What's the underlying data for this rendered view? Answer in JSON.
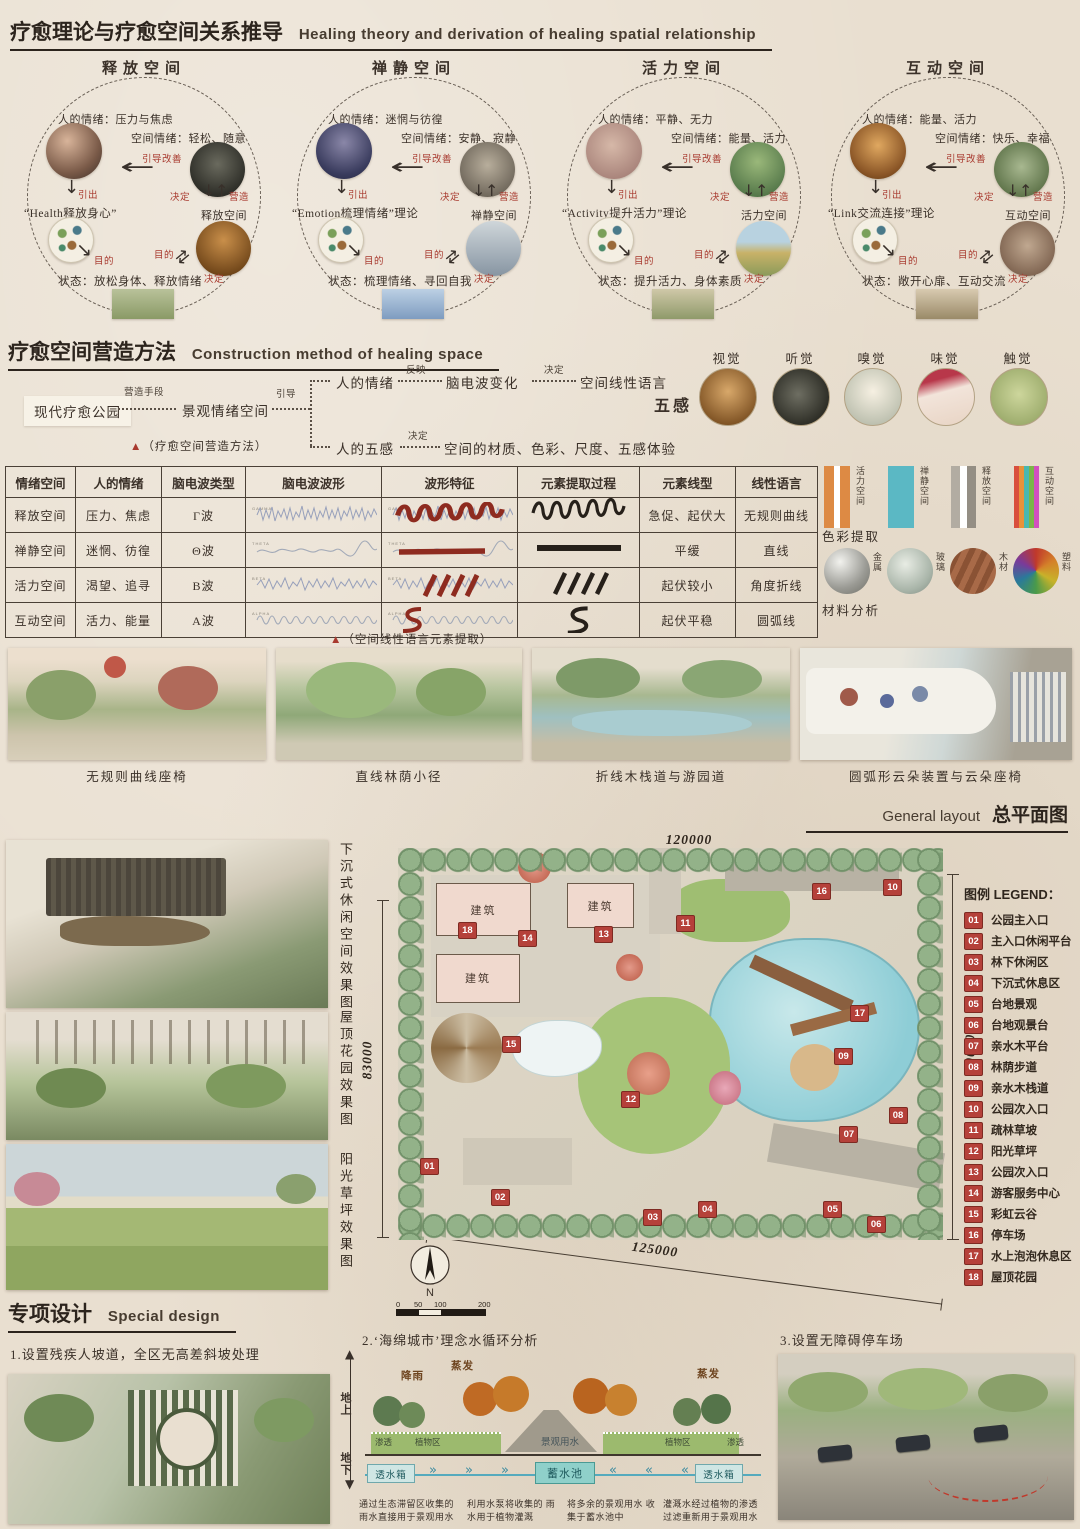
{
  "header": {
    "title_zh": "疗愈理论与疗愈空间关系推导",
    "title_en": "Healing theory and derivation of healing spatial relationship"
  },
  "circle_labels": {
    "improve": "引导改善",
    "lead": "引出",
    "decide": "决定",
    "create": "营造",
    "purpose": "目的"
  },
  "circles": [
    {
      "title": "释放空间",
      "human_emotion": "人的情绪：压力与焦虑",
      "space_emotion": "空间情绪：轻松、随意",
      "theory": "“Health释放身心”",
      "space_name": "释放空间",
      "state": "状态：放松身体、释放情绪"
    },
    {
      "title": "禅静空间",
      "human_emotion": "人的情绪：迷惘与彷徨",
      "space_emotion": "空间情绪：安静、寂静",
      "theory": "“Emotion梳理情绪”理论",
      "space_name": "禅静空间",
      "state": "状态：梳理情绪、寻回自我"
    },
    {
      "title": "活力空间",
      "human_emotion": "人的情绪：平静、无力",
      "space_emotion": "空间情绪：能量、活力",
      "theory": "“Activity提升活力”理论",
      "space_name": "活力空间",
      "state": "状态：提升活力、身体素质"
    },
    {
      "title": "互动空间",
      "human_emotion": "人的情绪：能量、活力",
      "space_emotion": "空间情绪：快乐、幸福",
      "theory": "“Link交流连接”理论",
      "space_name": "互动空间",
      "state": "状态：敞开心扉、互动交流"
    }
  ],
  "construction": {
    "title_zh": "疗愈空间营造方法",
    "title_en": "Construction method of healing space",
    "start": "现代疗愈公园",
    "m1": "营造手段",
    "mid": "景观情绪空间",
    "m2": "引导",
    "b1": [
      "人的情绪",
      "反映",
      "脑电波变化",
      "决定",
      "空间线性语言"
    ],
    "b2": [
      "人的五感",
      "决定",
      "空间的材质、色彩、尺度、五感体验"
    ],
    "caption_marker": "▲",
    "caption": "（疗愈空间营造方法）",
    "senses_label": "五感",
    "senses": [
      "视觉",
      "听觉",
      "嗅觉",
      "味觉",
      "触觉"
    ]
  },
  "eeg": {
    "headers": [
      "情绪空间",
      "人的情绪",
      "脑电波类型",
      "脑电波波形",
      "波形特征",
      "元素提取过程",
      "元素线型",
      "线性语言"
    ],
    "rows": [
      {
        "space": "释放空间",
        "emotion": "压力、焦虑",
        "wave_type": "Γ波",
        "wave_label": "GAMMA",
        "line_type": "急促、起伏大",
        "line_lang": "无规则曲线"
      },
      {
        "space": "禅静空间",
        "emotion": "迷惘、彷徨",
        "wave_type": "Θ波",
        "wave_label": "THETA",
        "line_type": "平缓",
        "line_lang": "直线"
      },
      {
        "space": "活力空间",
        "emotion": "渴望、追寻",
        "wave_type": "Β波",
        "wave_label": "BETA",
        "line_type": "起伏较小",
        "line_lang": "角度折线"
      },
      {
        "space": "互动空间",
        "emotion": "活力、能量",
        "wave_type": "Α波",
        "wave_label": "ALPHA",
        "line_type": "起伏平稳",
        "line_lang": "圆弧线"
      }
    ],
    "caption_marker": "▲",
    "caption": "（空间线性语言元素提取）"
  },
  "extraction": {
    "swatches": [
      {
        "label": "活力空间",
        "colors": [
          "#dd8a44",
          "#ffffff",
          "#dd8a44"
        ]
      },
      {
        "label": "禅静空间",
        "colors": [
          "#5bb8c4"
        ]
      },
      {
        "label": "释放空间",
        "colors": [
          "#b2aca2",
          "#ffffff",
          "#948e84"
        ]
      },
      {
        "label": "互动空间",
        "colors": [
          "#d94f3d",
          "#e8923a",
          "#49b8b0",
          "#7ab648",
          "#d24fc0"
        ]
      }
    ],
    "color_caption": "色彩提取",
    "materials": [
      {
        "label": "金属"
      },
      {
        "label": "玻璃"
      },
      {
        "label": "木材"
      },
      {
        "label": "塑料"
      }
    ],
    "material_caption": "材料分析"
  },
  "gallery": {
    "items": [
      {
        "caption": "无规则曲线座椅"
      },
      {
        "caption": "直线林荫小径"
      },
      {
        "caption": "折线木栈道与游园道"
      },
      {
        "caption": "圆弧形云朵装置与云朵座椅"
      }
    ]
  },
  "plan": {
    "title_en": "General layout",
    "title_zh": "总平面图",
    "render_captions": [
      "下沉式休闲空间效果图",
      "屋顶花园效果图",
      "阳光草坪效果图"
    ],
    "dim_top": "120000",
    "dim_left": "83000",
    "dim_right": "100000",
    "dim_bottom": "125000",
    "building": "建筑",
    "compass": "N",
    "scale": [
      "0",
      "50",
      "100",
      "200"
    ],
    "legend_title": "图例 LEGEND：",
    "legend": [
      {
        "num": "01",
        "label": "公园主入口"
      },
      {
        "num": "02",
        "label": "主入口休闲平台"
      },
      {
        "num": "03",
        "label": "林下休闲区"
      },
      {
        "num": "04",
        "label": "下沉式休息区"
      },
      {
        "num": "05",
        "label": "台地景观"
      },
      {
        "num": "06",
        "label": "台地观景台"
      },
      {
        "num": "07",
        "label": "亲水木平台"
      },
      {
        "num": "08",
        "label": "林荫步道"
      },
      {
        "num": "09",
        "label": "亲水木栈道"
      },
      {
        "num": "10",
        "label": "公园次入口"
      },
      {
        "num": "11",
        "label": "疏林草坡"
      },
      {
        "num": "12",
        "label": "阳光草坪"
      },
      {
        "num": "13",
        "label": "公园次入口"
      },
      {
        "num": "14",
        "label": "游客服务中心"
      },
      {
        "num": "15",
        "label": "彩虹云谷"
      },
      {
        "num": "16",
        "label": "停车场"
      },
      {
        "num": "17",
        "label": "水上泡泡休息区"
      },
      {
        "num": "18",
        "label": "屋顶花园"
      }
    ]
  },
  "special": {
    "title_zh": "专项设计",
    "title_en": "Special design",
    "item1": "1.设置残疾人坡道，全区无高差斜坡处理",
    "item2": "2.‘海绵城市’理念水循环分析",
    "item3": "3.设置无障碍停车场",
    "water": {
      "rain": "降雨",
      "evap": "蒸发",
      "above": "地上",
      "below": "地下",
      "seep": "渗透",
      "plant": "植物区",
      "use": "景观用水",
      "tank": "透水箱",
      "pool": "蓄水池",
      "captions": [
        "通过生态滞留区收集的 雨水直接用于景观用水",
        "利用水泵将收集的 雨水用于植物灌溉",
        "将多余的景观用水 收集于蓄水池中",
        "灌溉水经过植物的渗透 过滤重新用于景观用水"
      ]
    }
  }
}
